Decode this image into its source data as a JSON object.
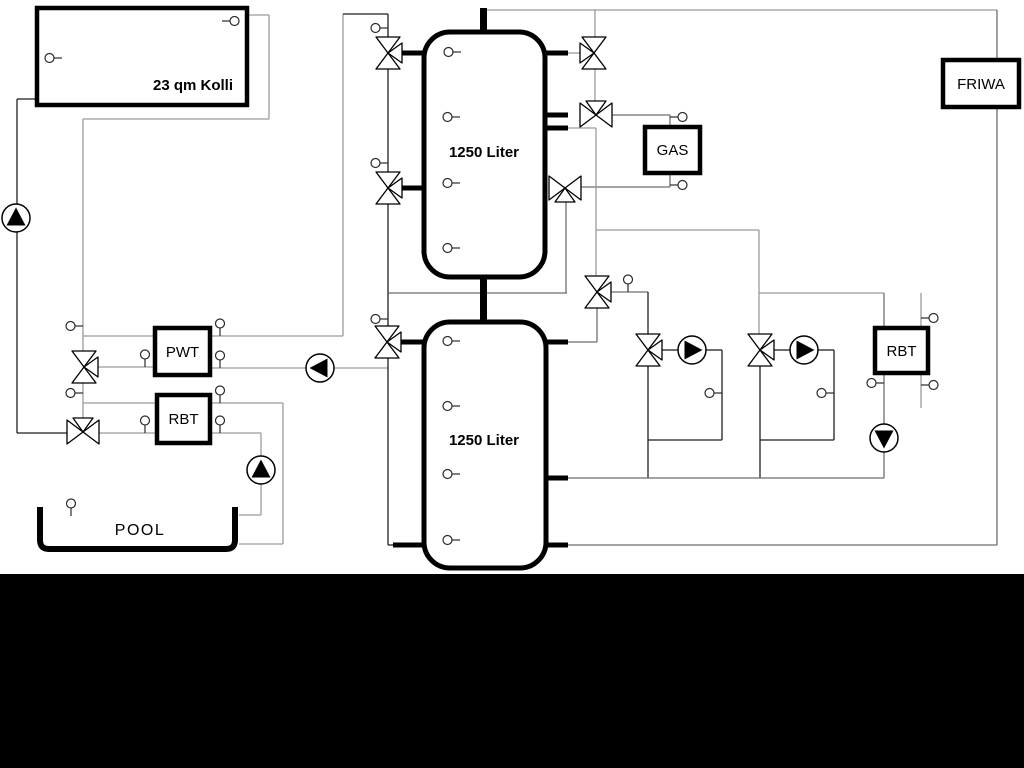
{
  "labels": {
    "collector": "23 qm Kolli",
    "tank_upper": "1250 Liter",
    "tank_lower": "1250 Liter",
    "pwt": "PWT",
    "rbt_left": "RBT",
    "gas": "GAS",
    "friwa": "FRIWA",
    "rbt_right": "RBT",
    "pool": "POOL"
  },
  "colors": {
    "background": "#ffffff",
    "outline": "#000000",
    "pipe_dark": "#1f1f1f",
    "pipe_gray": "#9a9a9a",
    "footer_bar": "#000000"
  }
}
